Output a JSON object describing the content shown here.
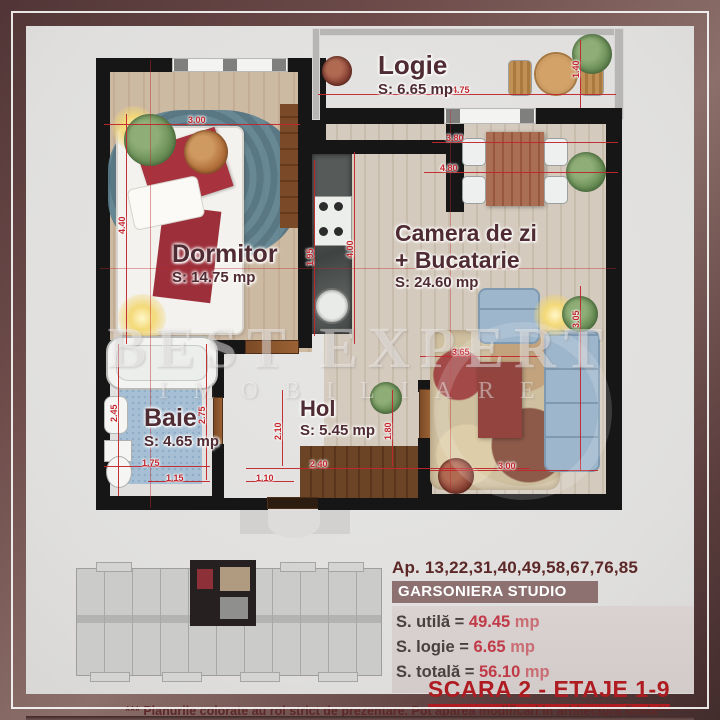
{
  "watermark": {
    "line1": "BEST EXPERT",
    "line2": "IMOBILIARE"
  },
  "rooms": {
    "logie": {
      "name": "Logie",
      "area": "S: 6.65 mp"
    },
    "dormitor": {
      "name": "Dormitor",
      "area": "S: 14.75 mp"
    },
    "living": {
      "line1": "Camera de zi",
      "line2": "+ Bucatarie",
      "area": "S: 24.60 mp"
    },
    "baie": {
      "name": "Baie",
      "area": "S: 4.65 mp"
    },
    "hol": {
      "name": "Hol",
      "area": "S: 5.45 mp"
    }
  },
  "dims": {
    "bedroom_w": "3.00",
    "logie_w": "4.75",
    "logie_d": "1.40",
    "bedroom_h": "4.40",
    "living_w1": "3.80",
    "living_w2": "4.80",
    "kitchen_l": "4.00",
    "kitchen_w": "1.95",
    "living_mid": "3.65",
    "sofa_h": "3.05",
    "living_bottom": "3.00",
    "baie_h1": "2.45",
    "baie_h2": "2.75",
    "baie_w1": "1.75",
    "baie_w2": "1.15",
    "hol_w1": "2.40",
    "hol_w2": "1.10",
    "hol_h1": "2.10",
    "hol_h2": "1.80"
  },
  "info": {
    "apartments": "Ap. 13,22,31,40,49,58,67,76,85",
    "unit_type": "GARSONIERA STUDIO",
    "rows": [
      {
        "label": "S. utilă =",
        "value": "49.45",
        "unit": "mp"
      },
      {
        "label": "S. logie =",
        "value": "6.65",
        "unit": "mp"
      },
      {
        "label": "S. totală =",
        "value": "56.10",
        "unit": "mp"
      }
    ],
    "scara": "SCARA 2 - ETAJE 1-9",
    "disclaimer": "*** Planurile colorate au rol strict de prezentare. Pot aparea modificari in arhitectura finala***"
  },
  "colors": {
    "dimension_red": "#c1272d",
    "accent_red": "#ae1c21",
    "maroon": "#5c2727",
    "frame": "#5d3c3c"
  }
}
